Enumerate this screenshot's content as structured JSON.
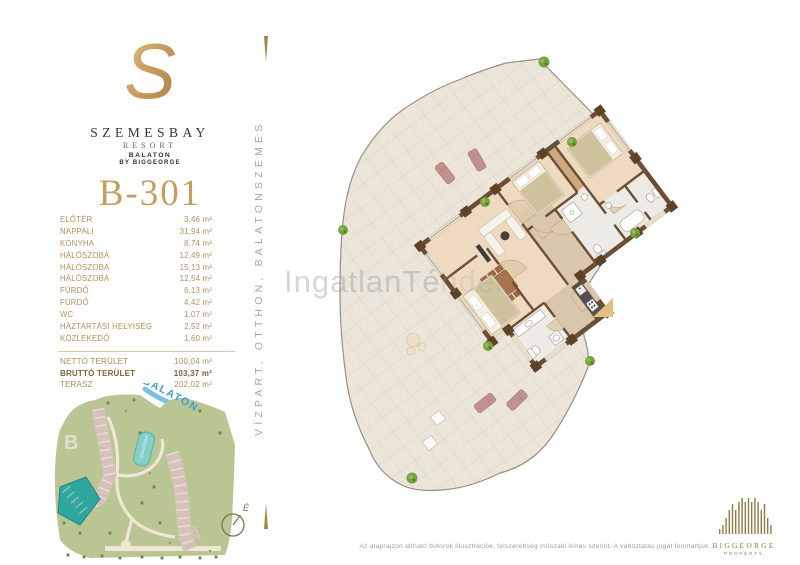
{
  "brand": {
    "logo_letter": "S",
    "name": "SZEMESBAY",
    "type": "RESORT",
    "location": "BALATON",
    "developer": "BY BIGGEORGE"
  },
  "unit": {
    "number": "B-301"
  },
  "room_list": [
    {
      "label": "ELŐTÉR",
      "area": "3,46 m²"
    },
    {
      "label": "NAPPALI",
      "area": "31,94 m²"
    },
    {
      "label": "KONYHA",
      "area": "8,74 m²"
    },
    {
      "label": "HÁLÓSZOBA",
      "area": "12,49 m²"
    },
    {
      "label": "HÁLÓSZOBA",
      "area": "15,13 m²"
    },
    {
      "label": "HÁLÓSZOBA",
      "area": "12,54 m²"
    },
    {
      "label": "FÜRDŐ",
      "area": "6,13 m²"
    },
    {
      "label": "FÜRDŐ",
      "area": "4,42 m²"
    },
    {
      "label": "WC",
      "area": "1,07 m²"
    },
    {
      "label": "HÁZTARTÁSI HELYISÉG",
      "area": "2,52 m²"
    },
    {
      "label": "KÖZLEKEDŐ",
      "area": "1,60 m²"
    }
  ],
  "totals": [
    {
      "label": "NETTÓ TERÜLET",
      "area": "100,04 m²"
    },
    {
      "label": "BRUTTÓ TERÜLET",
      "area": "103,37 m²"
    },
    {
      "label": "TERASZ",
      "area": "202,02 m²"
    }
  ],
  "vertical_tagline": "VÍZPART, OTTHON, BALATONSZEMES",
  "site_map": {
    "lake": "BALATON",
    "pool": "MEDENCE",
    "building_a": "A",
    "building_b": "B"
  },
  "compass": {
    "north": "É"
  },
  "watermark": {
    "visible": "IngatlanTé",
    "faded": "nder"
  },
  "footer": {
    "disclaimer": "Az alaprajzon látható bútorok illusztrációk, felszereltség műszaki leírás szerint. A változtatás jogát fenntartjuk.",
    "brand": "BIGGEORGE",
    "brand_sub": "PROPERTY"
  },
  "colors": {
    "gold": "#c79e60",
    "label_tan": "#b29158",
    "wall_brown": "#6b4e33",
    "terrace_tile": "#ebe5da",
    "floor_wood": "#eed9c1",
    "map_green": "#b9c693",
    "unit_teal": "#2fa79f",
    "lake_blue": "#3d9bd4",
    "logo_olive": "#8d7c46"
  }
}
